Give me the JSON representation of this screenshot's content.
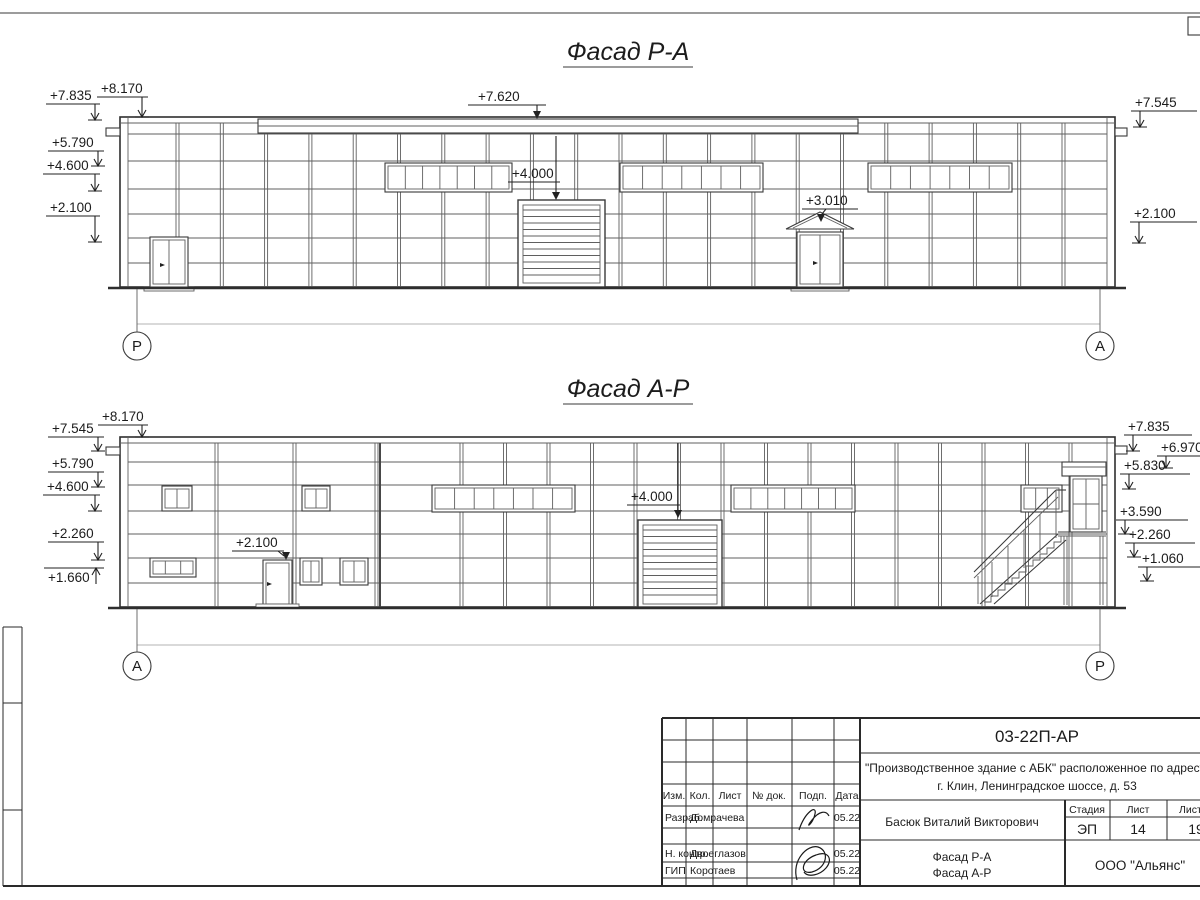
{
  "f1": {
    "title": "Фасад Р-А",
    "axes": {
      "left": "Р",
      "right": "А"
    },
    "marks_left": [
      "+7.835",
      "+8.170",
      "+5.790",
      "+4.600",
      "+2.100"
    ],
    "marks_center": [
      "+7.620",
      "+4.000",
      "+3.010"
    ],
    "marks_right": [
      "+7.545",
      "+2.100"
    ]
  },
  "f2": {
    "title": "Фасад А-Р",
    "axes": {
      "left": "А",
      "right": "Р"
    },
    "marks_left": [
      "+7.545",
      "+8.170",
      "+5.790",
      "+4.600",
      "+2.260",
      "+1.660"
    ],
    "marks_center": [
      "+2.100",
      "+4.000"
    ],
    "marks_right": [
      "+7.835",
      "+6.970",
      "+5.830",
      "+3.590",
      "+2.260",
      "+1.060"
    ]
  },
  "titleblock": {
    "doc_number": "03-22П-АР",
    "project_line1": "\"Производственное здание с АБК\" расположенное по адресу:",
    "project_line2": "г. Клин, Ленинградское шоссе, д. 53",
    "col_izm": "Изм.",
    "col_kol": "Кол.",
    "col_list": "Лист",
    "col_doc": "№ док.",
    "col_podp": "Подп.",
    "col_data": "Дата",
    "rows": [
      {
        "role": "Разраб.",
        "name": "Домрачева",
        "date": "05.22"
      },
      {
        "role": "Н. контр.",
        "name": "Двоеглазов",
        "date": "05.22"
      },
      {
        "role": "ГИП",
        "name": "Коротаев",
        "date": "05.22"
      }
    ],
    "approver": "Басюк Виталий Викторович",
    "stage_label": "Стадия",
    "sheet_label": "Лист",
    "sheets_label": "Листов",
    "stage": "ЭП",
    "sheet": "14",
    "sheets": "19",
    "content_line1": "Фасад Р-А",
    "content_line2": "Фасад А-Р",
    "company": "ООО \"Альянс\""
  }
}
